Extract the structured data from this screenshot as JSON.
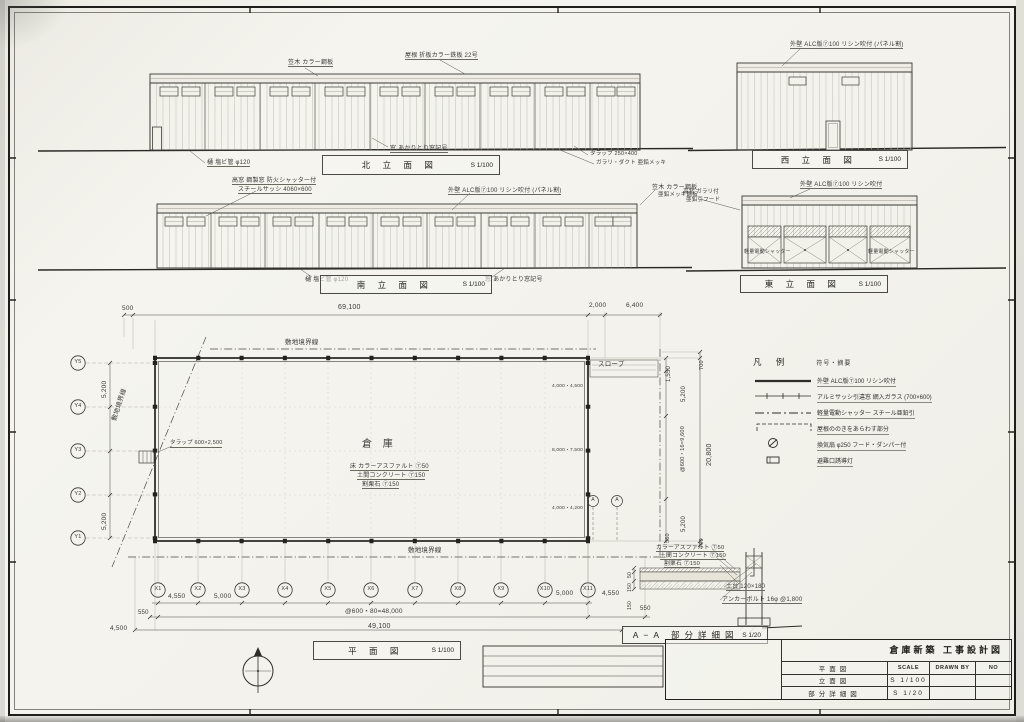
{
  "colors": {
    "paper": "#f4f3ee",
    "ink": "#3a3a38",
    "heavy_line": "#23221f"
  },
  "title_block": {
    "project": "倉庫新築 工事設計図",
    "header": {
      "scale": "SCALE",
      "drawn_by": "DRAWN BY",
      "no": "NO"
    },
    "sheets": [
      {
        "name": "平面図",
        "scale": ""
      },
      {
        "name": "立面図",
        "scale": "S 1/100"
      },
      {
        "name": "部分詳細図",
        "scale": "S 1/20"
      }
    ]
  },
  "legend": {
    "title": "凡 例",
    "subtitle": "符号・摘要",
    "rows": [
      {
        "symbol": "wall-line",
        "text": "外壁 ALC版⑦100 リシン吹付"
      },
      {
        "symbol": "sash-line",
        "text": "アルミサッシ引違窓 網入ガラス (700×600)"
      },
      {
        "symbol": "shutter-line",
        "text": "軽量電動シャッター スチール亜鉛引"
      },
      {
        "symbol": "eave-bracket",
        "text": "屋根ののきをあらわす部分"
      },
      {
        "symbol": "vent-fan",
        "text": "換気扇 φ250 フード・ダンパー付"
      },
      {
        "symbol": "exit-light",
        "text": "避難口誘導灯"
      }
    ]
  },
  "view_titles": [
    {
      "n": "north-elevation-title",
      "label": "北 立 面 図",
      "scale": "S 1/100",
      "x": 322,
      "y": 155,
      "w": 178,
      "h": 20
    },
    {
      "n": "west-elevation-title",
      "label": "西 立 面 図",
      "scale": "S 1/100",
      "x": 752,
      "y": 150,
      "w": 156,
      "h": 19
    },
    {
      "n": "south-elevation-title",
      "label": "南 立 面 図",
      "scale": "S 1/100",
      "x": 320,
      "y": 275,
      "w": 172,
      "h": 19
    },
    {
      "n": "east-elevation-title",
      "label": "東 立 面 図",
      "scale": "S 1/100",
      "x": 740,
      "y": 275,
      "w": 148,
      "h": 18
    },
    {
      "n": "plan-title",
      "label": "平 面 図",
      "scale": "S 1/100",
      "x": 313,
      "y": 641,
      "w": 148,
      "h": 19
    },
    {
      "n": "detail-section-title",
      "label": "A−A 部分詳細図",
      "scale": "S 1/20",
      "x": 622,
      "y": 626,
      "w": 146,
      "h": 18
    }
  ],
  "annotations": [
    {
      "n": "callout-coping-north",
      "t": "笠木 カラー鋼板",
      "x": 288,
      "y": 60,
      "fs": 6,
      "u": 1
    },
    {
      "n": "callout-roof-north",
      "t": "屋根 折板カラー鉄板 22号",
      "x": 405,
      "y": 53,
      "fs": 6,
      "u": 1
    },
    {
      "n": "callout-gutter-north",
      "t": "樋 塩ビ管 φ120",
      "x": 207,
      "y": 160,
      "fs": 6,
      "u": 1
    },
    {
      "n": "note-window-symbol-north",
      "t": "窓 あかりとり窓記号",
      "x": 390,
      "y": 146,
      "fs": 6,
      "u": 1
    },
    {
      "n": "callout-ladder-north",
      "t": "タラップ 250×400",
      "x": 590,
      "y": 152,
      "fs": 5.5
    },
    {
      "n": "callout-duct-north",
      "t": "ガラリ・ダクト 亜鉛メッキ",
      "x": 596,
      "y": 161,
      "fs": 5.5
    },
    {
      "n": "callout-wall-west",
      "t": "外壁 ALC版⑦100 リシン吹付 (パネル割)",
      "x": 790,
      "y": 42,
      "fs": 6,
      "u": 1
    },
    {
      "n": "callout-highwindow-south",
      "t": "高窓 鋼製窓 防火シャッター付",
      "x": 232,
      "y": 178,
      "fs": 6,
      "u": 1
    },
    {
      "n": "callout-sash-south",
      "t": "スチールサッシ 4060×600",
      "x": 238,
      "y": 187,
      "fs": 6,
      "u": 1
    },
    {
      "n": "callout-wall-south",
      "t": "外壁 ALC版⑦100 リシン吹付 (パネル割)",
      "x": 448,
      "y": 188,
      "fs": 6,
      "u": 1
    },
    {
      "n": "callout-coping-south",
      "t": "笠木 カラー鋼板",
      "x": 652,
      "y": 185,
      "fs": 6
    },
    {
      "n": "callout-coping-south-2",
      "t": "亜鉛メッキ鋼板",
      "x": 658,
      "y": 193,
      "fs": 5.5
    },
    {
      "n": "callout-gutter-south",
      "t": "樋 塩ビ管 φ120",
      "x": 305,
      "y": 277,
      "fs": 6
    },
    {
      "n": "note-window-symbol-south",
      "t": "窓 あかりとり窓記号",
      "x": 485,
      "y": 277,
      "fs": 6
    },
    {
      "n": "callout-highwindow-east",
      "t": "高窓 ガラリ付",
      "x": 683,
      "y": 190,
      "fs": 5.5
    },
    {
      "n": "callout-highwindow-east-2",
      "t": "亜鉛引フード",
      "x": 686,
      "y": 198,
      "fs": 5.5
    },
    {
      "n": "callout-wall-east",
      "t": "外壁 ALC版⑦100 リシン吹付",
      "x": 800,
      "y": 182,
      "fs": 6,
      "u": 1
    },
    {
      "n": "label-shutter-east-1",
      "t": "軽量電動シャッター",
      "x": 744,
      "y": 250,
      "fs": 5
    },
    {
      "n": "label-shutter-east-2",
      "t": "軽量電動シャッター",
      "x": 868,
      "y": 250,
      "fs": 5
    },
    {
      "n": "dim-500",
      "t": "500",
      "x": 122,
      "y": 306,
      "fs": 6.5
    },
    {
      "n": "dim-69100",
      "t": "69,100",
      "x": 338,
      "y": 304,
      "fs": 7
    },
    {
      "n": "dim-2000",
      "t": "2,000",
      "x": 589,
      "y": 303,
      "fs": 6.5
    },
    {
      "n": "dim-6400",
      "t": "6,400",
      "x": 626,
      "y": 303,
      "fs": 6.5
    },
    {
      "n": "label-site-boundary-top",
      "t": "敷地境界線",
      "x": 285,
      "y": 340,
      "fs": 6.5
    },
    {
      "n": "label-site-boundary-left",
      "t": "敷地境界線",
      "x": 112,
      "y": 420,
      "fs": 6.5,
      "r": -72
    },
    {
      "n": "label-site-boundary-bottom",
      "t": "敷地境界線",
      "x": 408,
      "y": 548,
      "fs": 6.5
    },
    {
      "n": "label-slope",
      "t": "スロープ",
      "x": 598,
      "y": 362,
      "fs": 6.5
    },
    {
      "n": "label-warehouse",
      "t": "倉 庫",
      "x": 362,
      "y": 440,
      "fs": 10,
      "ls": 4
    },
    {
      "n": "label-floor-asphalt",
      "t": "床 カラーアスファルト ⑦50",
      "x": 350,
      "y": 464,
      "fs": 6,
      "u": 1
    },
    {
      "n": "label-floor-concrete",
      "t": "土間コンクリート ⑦150",
      "x": 357,
      "y": 473,
      "fs": 6,
      "u": 1
    },
    {
      "n": "label-floor-gravel",
      "t": "割栗石 ⑦150",
      "x": 362,
      "y": 482,
      "fs": 6,
      "u": 1
    },
    {
      "n": "callout-ladder-plan",
      "t": "タラップ 600×2,500",
      "x": 170,
      "y": 441,
      "fs": 5.5,
      "u": 1
    },
    {
      "n": "label-opening-1",
      "t": "4,000・4,500",
      "x": 552,
      "y": 384,
      "fs": 4.8
    },
    {
      "n": "label-opening-2",
      "t": "8,000・7,500",
      "x": 552,
      "y": 448,
      "fs": 4.8
    },
    {
      "n": "label-opening-3",
      "t": "4,000・4,200",
      "x": 552,
      "y": 506,
      "fs": 4.8
    },
    {
      "n": "dim-1550",
      "t": "1,550",
      "x": 666,
      "y": 382,
      "fs": 6,
      "r": -90
    },
    {
      "n": "dim-5200-right-top",
      "t": "5,200",
      "x": 681,
      "y": 402,
      "fs": 6,
      "r": -90
    },
    {
      "n": "dim-600x16-9600",
      "t": "@600・16=9,600",
      "x": 681,
      "y": 472,
      "fs": 5.5,
      "r": -90
    },
    {
      "n": "dim-5200-right-bottom",
      "t": "5,200",
      "x": 681,
      "y": 532,
      "fs": 6,
      "r": -90
    },
    {
      "n": "dim-550-right",
      "t": "550",
      "x": 666,
      "y": 543,
      "fs": 5.5,
      "r": -90
    },
    {
      "n": "dim-20800",
      "t": "20,800",
      "x": 706,
      "y": 466,
      "fs": 7,
      "r": -90
    },
    {
      "n": "dim-700-top",
      "t": "700",
      "x": 700,
      "y": 370,
      "fs": 5.5,
      "r": -90
    },
    {
      "n": "dim-700-bottom",
      "t": "700",
      "x": 700,
      "y": 548,
      "fs": 5.5,
      "r": -90
    },
    {
      "n": "dim-5200-left-top",
      "t": "5,200",
      "x": 102,
      "y": 398,
      "fs": 6.5,
      "r": -90
    },
    {
      "n": "dim-5200-left-bottom",
      "t": "5,200",
      "x": 102,
      "y": 530,
      "fs": 6.5,
      "r": -90
    },
    {
      "n": "dim-4550-left",
      "t": "4,550",
      "x": 168,
      "y": 594,
      "fs": 6.5
    },
    {
      "n": "dim-5000-left",
      "t": "5,000",
      "x": 214,
      "y": 594,
      "fs": 6.5
    },
    {
      "n": "dim-5000-right",
      "t": "5,000",
      "x": 556,
      "y": 591,
      "fs": 6.5
    },
    {
      "n": "dim-4550-right",
      "t": "4,550",
      "x": 602,
      "y": 591,
      "fs": 6.5
    },
    {
      "n": "dim-550-bl",
      "t": "550",
      "x": 138,
      "y": 610,
      "fs": 6
    },
    {
      "n": "dim-600x80-48000",
      "t": "@600・80=48,000",
      "x": 345,
      "y": 609,
      "fs": 6.5
    },
    {
      "n": "dim-550-br",
      "t": "550",
      "x": 640,
      "y": 606,
      "fs": 6
    },
    {
      "n": "dim-49100",
      "t": "49,100",
      "x": 368,
      "y": 623,
      "fs": 7
    },
    {
      "n": "dim-4500",
      "t": "4,500",
      "x": 110,
      "y": 626,
      "fs": 6.5
    },
    {
      "n": "detail-layer-asphalt",
      "t": "カラーアスファルト ⑦50",
      "x": 656,
      "y": 545,
      "fs": 5.8,
      "u": 1
    },
    {
      "n": "detail-layer-concrete",
      "t": "土間コンクリート ⑦150",
      "x": 660,
      "y": 553,
      "fs": 5.8,
      "u": 1
    },
    {
      "n": "detail-layer-gravel",
      "t": "割栗石 ⑦150",
      "x": 664,
      "y": 561,
      "fs": 5.8,
      "u": 1
    },
    {
      "n": "detail-sill",
      "t": "土台 120×180",
      "x": 726,
      "y": 584,
      "fs": 6,
      "u": 1
    },
    {
      "n": "detail-anchor-bolt",
      "t": "アンカーボルト 16φ @1,800",
      "x": 722,
      "y": 597,
      "fs": 6,
      "u": 1
    },
    {
      "n": "detail-dim-50",
      "t": "50",
      "x": 628,
      "y": 578,
      "fs": 5,
      "r": -90
    },
    {
      "n": "detail-dim-150a",
      "t": "150",
      "x": 628,
      "y": 592,
      "fs": 5,
      "r": -90
    },
    {
      "n": "detail-dim-150b",
      "t": "150",
      "x": 628,
      "y": 610,
      "fs": 5,
      "r": -90
    },
    {
      "n": "grid-label-x1",
      "t": "X1",
      "x": 150,
      "y": 587,
      "fs": 5.5,
      "w": 16,
      "ta": "center"
    },
    {
      "n": "grid-label-x2",
      "t": "X2",
      "x": 190,
      "y": 587,
      "fs": 5.5,
      "w": 16,
      "ta": "center"
    },
    {
      "n": "grid-label-x3",
      "t": "X3",
      "x": 234,
      "y": 587,
      "fs": 5.5,
      "w": 16,
      "ta": "center"
    },
    {
      "n": "grid-label-x4",
      "t": "X4",
      "x": 277,
      "y": 587,
      "fs": 5.5,
      "w": 16,
      "ta": "center"
    },
    {
      "n": "grid-label-x5",
      "t": "X5",
      "x": 320,
      "y": 587,
      "fs": 5.5,
      "w": 16,
      "ta": "center"
    },
    {
      "n": "grid-label-x6",
      "t": "X6",
      "x": 363,
      "y": 587,
      "fs": 5.5,
      "w": 16,
      "ta": "center"
    },
    {
      "n": "grid-label-x7",
      "t": "X7",
      "x": 407,
      "y": 587,
      "fs": 5.5,
      "w": 16,
      "ta": "center"
    },
    {
      "n": "grid-label-x8",
      "t": "X8",
      "x": 450,
      "y": 587,
      "fs": 5.5,
      "w": 16,
      "ta": "center"
    },
    {
      "n": "grid-label-x9",
      "t": "X9",
      "x": 493,
      "y": 587,
      "fs": 5.5,
      "w": 16,
      "ta": "center"
    },
    {
      "n": "grid-label-x10",
      "t": "X10",
      "x": 537,
      "y": 587,
      "fs": 5.5,
      "w": 16,
      "ta": "center"
    },
    {
      "n": "grid-label-x11",
      "t": "X11",
      "x": 580,
      "y": 587,
      "fs": 5.5,
      "w": 16,
      "ta": "center"
    },
    {
      "n": "grid-label-y5",
      "t": "Y5",
      "x": 70,
      "y": 360,
      "fs": 5.5,
      "w": 16,
      "ta": "center"
    },
    {
      "n": "grid-label-y4",
      "t": "Y4",
      "x": 70,
      "y": 404,
      "fs": 5.5,
      "w": 16,
      "ta": "center"
    },
    {
      "n": "grid-label-y3",
      "t": "Y3",
      "x": 70,
      "y": 448,
      "fs": 5.5,
      "w": 16,
      "ta": "center"
    },
    {
      "n": "grid-label-y2",
      "t": "Y2",
      "x": 70,
      "y": 492,
      "fs": 5.5,
      "w": 16,
      "ta": "center"
    },
    {
      "n": "grid-label-y1",
      "t": "Y1",
      "x": 70,
      "y": 535,
      "fs": 5.5,
      "w": 16,
      "ta": "center"
    },
    {
      "n": "section-mark-a1",
      "t": "A",
      "x": 588,
      "y": 498,
      "fs": 5,
      "w": 10,
      "ta": "center"
    },
    {
      "n": "section-mark-a2",
      "t": "A",
      "x": 612,
      "y": 498,
      "fs": 5,
      "w": 10,
      "ta": "center"
    }
  ]
}
